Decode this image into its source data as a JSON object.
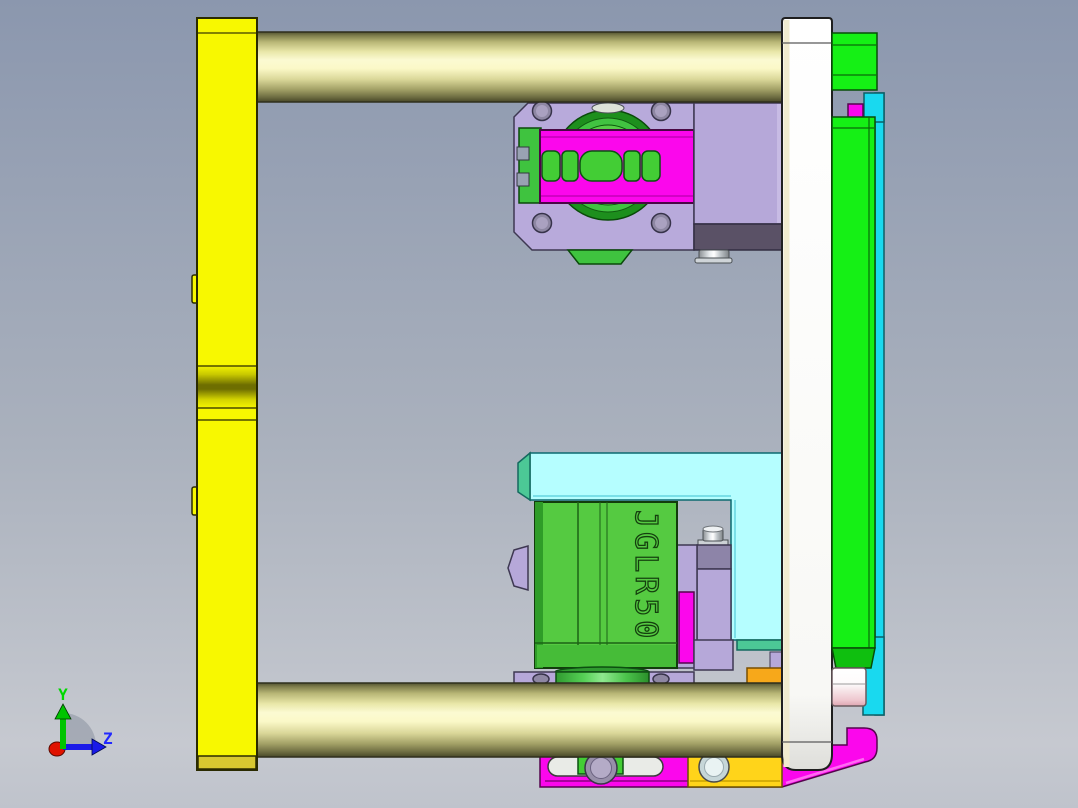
{
  "viewport": {
    "app_type": "cad-3d-viewport",
    "part_label": "JGLR50",
    "axis_triad": {
      "y_label": "Y",
      "z_label": "Z"
    },
    "palette": {
      "background_top": "#8b97ae",
      "background_bottom": "#c6c9d0",
      "bright_yellow_plate": "#f8f800",
      "rod_cream": "#fbfad2",
      "bright_green_panel": "#15f015",
      "carriage_green": "#55ca41",
      "magenta": "#fb07ec",
      "lavender": "#b6a8d9",
      "dark_purple_band": "#5a5166",
      "cyan_strip": "#19d9ef",
      "light_cyan_bracket": "#b5feff",
      "teal_accent": "#4cc896",
      "orange_block": "#f7a81a",
      "gold_plate": "#ffd41a",
      "white_end_plate": "#ffffff",
      "pink_roller": "#eec6ce",
      "axis_y_green": "#00c400",
      "axis_z_blue": "#1a1ae8",
      "origin_red": "#e01200"
    }
  }
}
